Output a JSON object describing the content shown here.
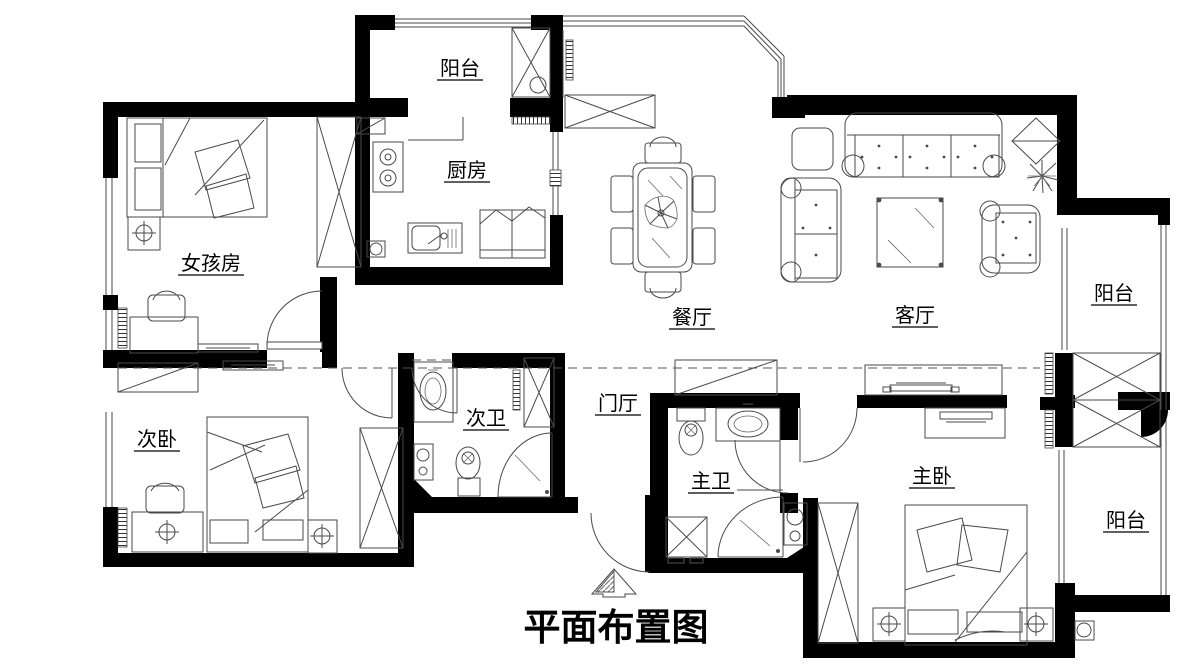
{
  "title": "平面布置图",
  "rooms": {
    "balcony_top": "阳台",
    "kitchen": "厨房",
    "girls_room": "女孩房",
    "dining": "餐厅",
    "living": "客厅",
    "balcony_right": "阳台",
    "second_bedroom": "次卧",
    "second_bath": "次卫",
    "foyer": "门厅",
    "master_bath": "主卫",
    "master_bedroom": "主卧",
    "balcony_bottom": "阳台"
  },
  "colors": {
    "wall": "#000000",
    "furniture_line": "#4a4a4a",
    "background": "#ffffff"
  }
}
